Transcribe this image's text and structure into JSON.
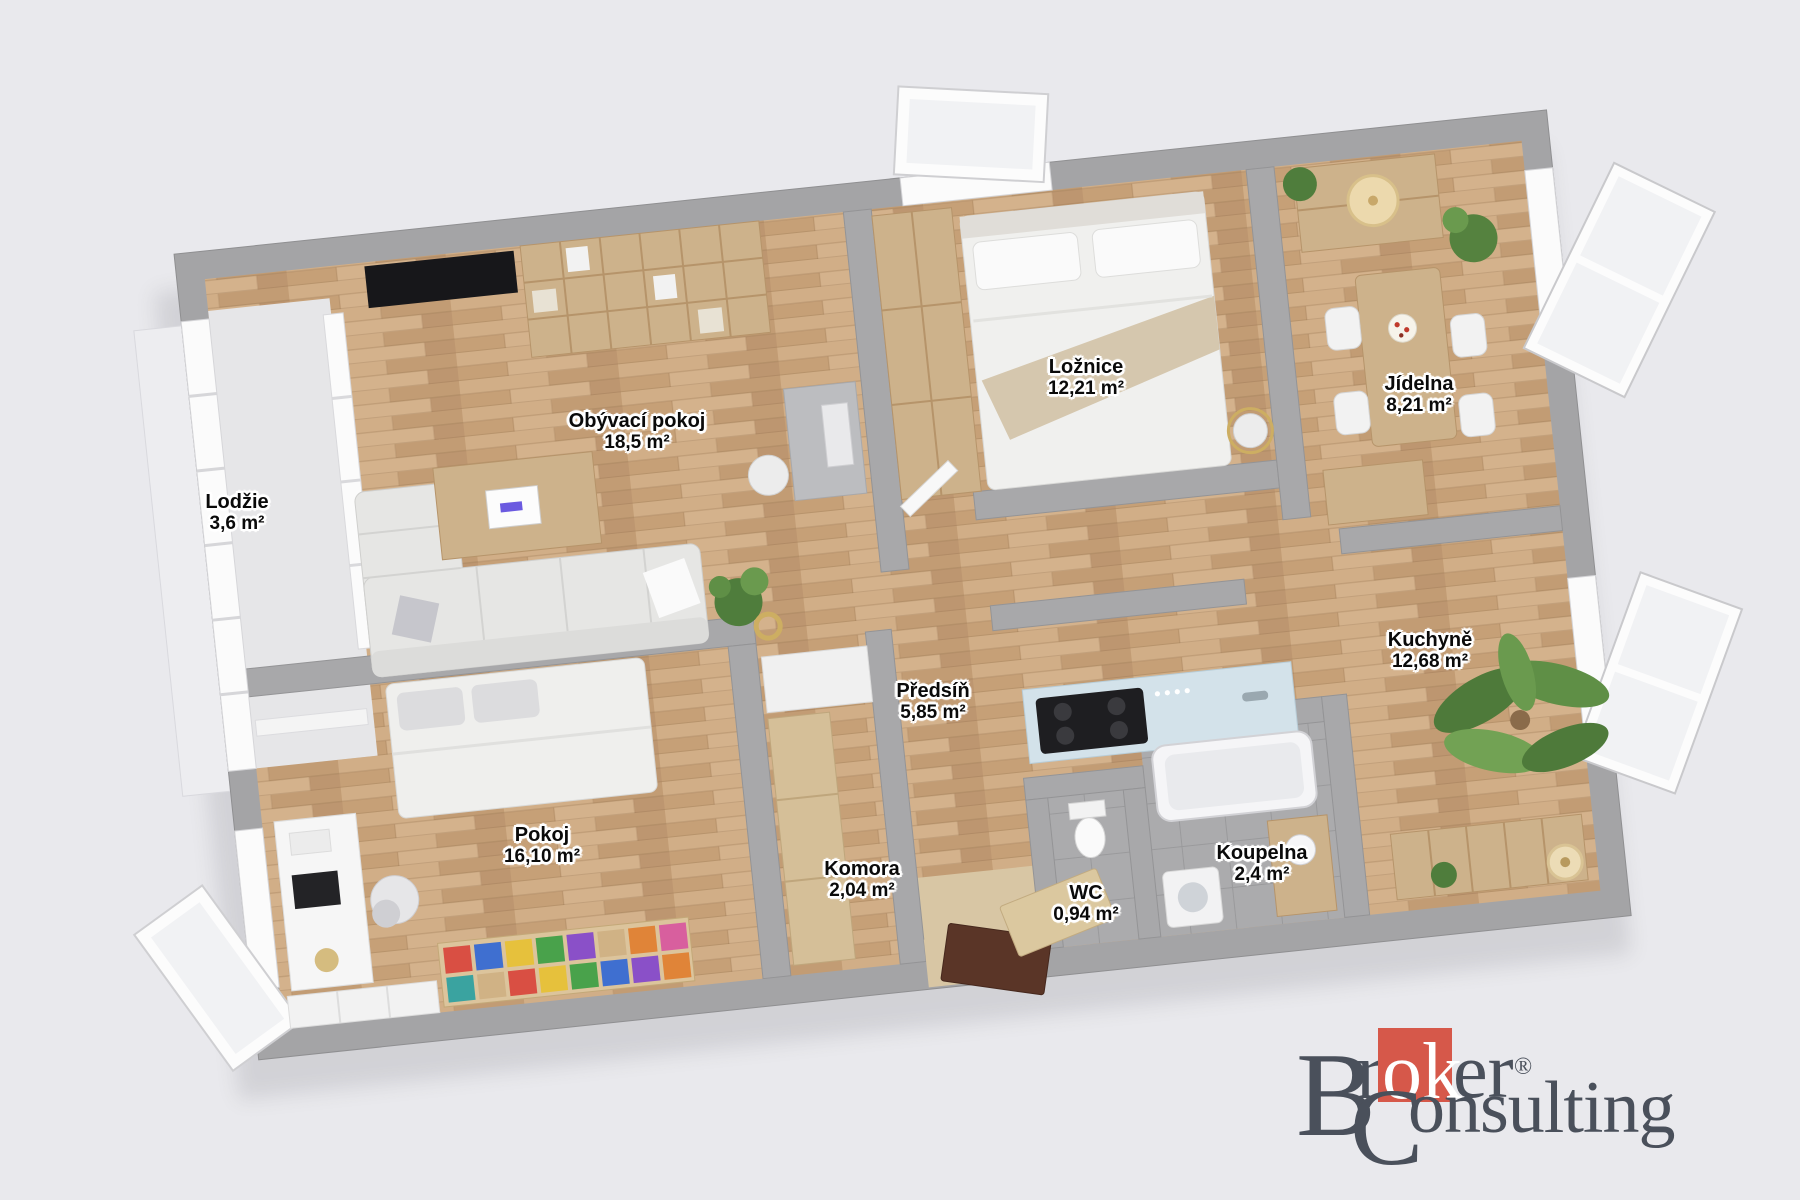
{
  "page": {
    "background": "#e9e9ed"
  },
  "floorplan": {
    "rooms": [
      {
        "id": "lodzie",
        "name": "Lodžie",
        "area": "3,6 m²"
      },
      {
        "id": "obyvaci-pokoj",
        "name": "Obývací pokoj",
        "area": "18,5 m²"
      },
      {
        "id": "loznice",
        "name": "Ložnice",
        "area": "12,21 m²"
      },
      {
        "id": "jidelna",
        "name": "Jídelna",
        "area": "8,21 m²"
      },
      {
        "id": "kuchyne",
        "name": "Kuchyně",
        "area": "12,68 m²"
      },
      {
        "id": "predsin",
        "name": "Předsíň",
        "area": "5,85 m²"
      },
      {
        "id": "pokoj",
        "name": "Pokoj",
        "area": "16,10 m²"
      },
      {
        "id": "komora",
        "name": "Komora",
        "area": "2,04 m²"
      },
      {
        "id": "wc",
        "name": "WC",
        "area": "0,94 m²"
      },
      {
        "id": "koupelna",
        "name": "Koupelna",
        "area": "2,4 m²"
      }
    ],
    "colors": {
      "background": "#e9e9ed",
      "wall": "#a4a4a6",
      "wood_floor": "#c8a37d",
      "tile_floor": "#ababad",
      "label_text": "#0a0a0a",
      "label_halo": "#ffffff"
    }
  },
  "branding": {
    "initial_b": "B",
    "part_r": "r",
    "accent_ok": "ok",
    "part_er": "er",
    "registered": "®",
    "initial_c": "C",
    "part_onsulting": "onsulting",
    "accent_color": "#d6584a",
    "text_color": "#4a505b"
  }
}
